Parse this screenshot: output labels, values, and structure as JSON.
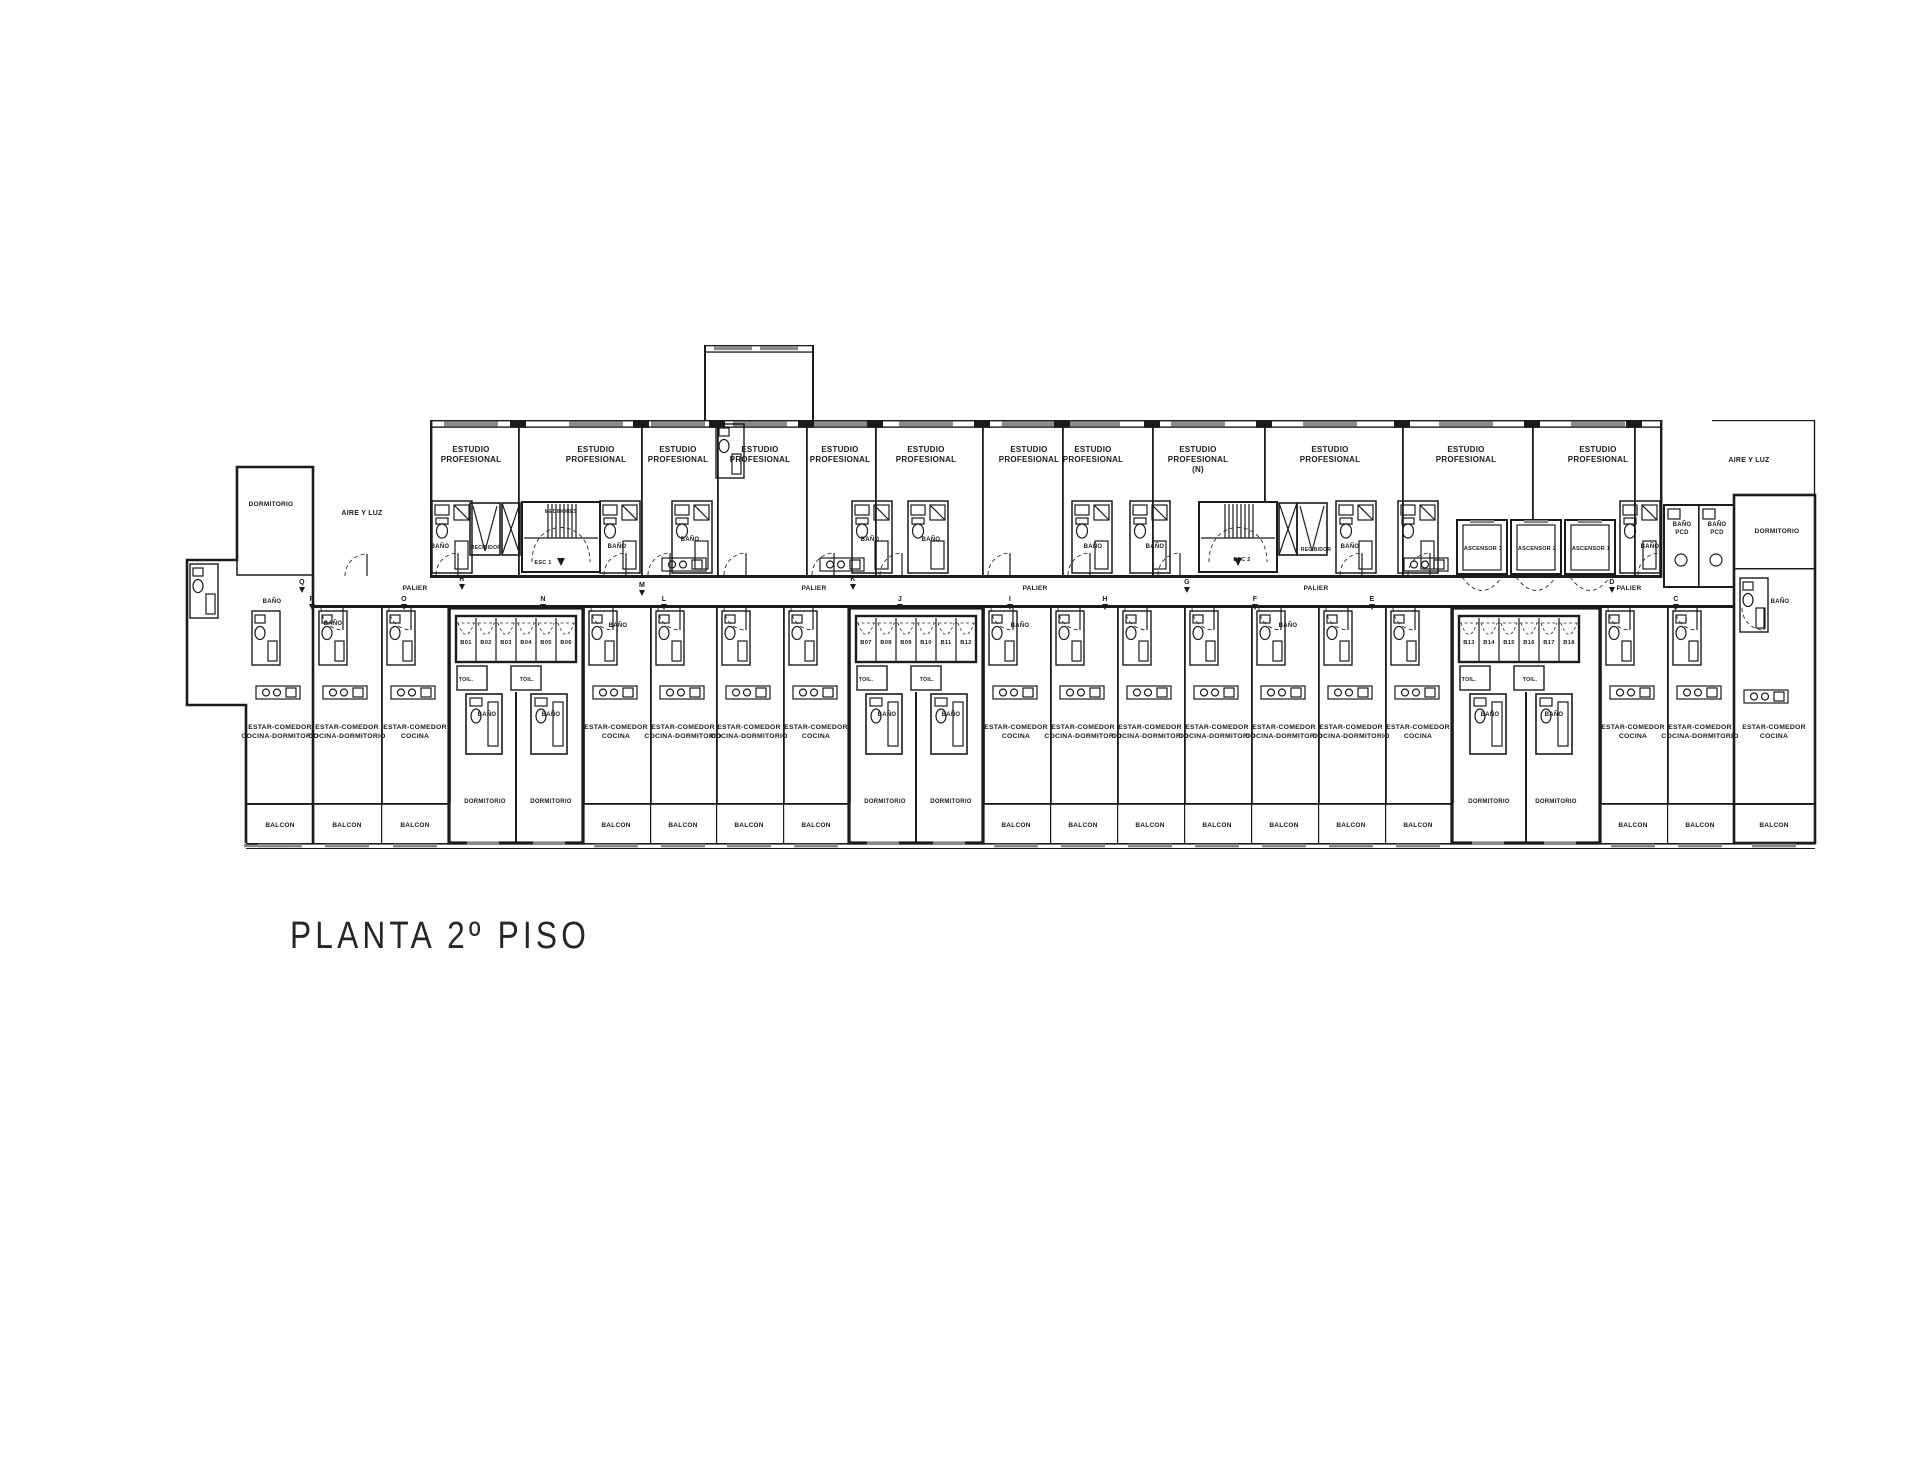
{
  "plan": {
    "title": "PLANTA 2º PISO",
    "labels": [
      {
        "n": "room-label-estudio",
        "t": [
          "ESTUDIO",
          "PROFESIONAL"
        ],
        "x": 471,
        "y": 452,
        "s": 8,
        "dy": 10
      },
      {
        "n": "room-label-estudio",
        "t": [
          "ESTUDIO",
          "PROFESIONAL"
        ],
        "x": 596,
        "y": 452,
        "s": 8,
        "dy": 10
      },
      {
        "n": "room-label-estudio",
        "t": [
          "ESTUDIO",
          "PROFESIONAL"
        ],
        "x": 678,
        "y": 452,
        "s": 8,
        "dy": 10
      },
      {
        "n": "room-label-estudio",
        "t": [
          "ESTUDIO",
          "PROFESIONAL"
        ],
        "x": 760,
        "y": 452,
        "s": 8,
        "dy": 10
      },
      {
        "n": "room-label-estudio",
        "t": [
          "ESTUDIO",
          "PROFESIONAL"
        ],
        "x": 840,
        "y": 452,
        "s": 8,
        "dy": 10
      },
      {
        "n": "room-label-estudio",
        "t": [
          "ESTUDIO",
          "PROFESIONAL"
        ],
        "x": 926,
        "y": 452,
        "s": 8,
        "dy": 10
      },
      {
        "n": "room-label-estudio",
        "t": [
          "ESTUDIO",
          "PROFESIONAL"
        ],
        "x": 1029,
        "y": 452,
        "s": 8,
        "dy": 10
      },
      {
        "n": "room-label-estudio",
        "t": [
          "ESTUDIO",
          "PROFESIONAL"
        ],
        "x": 1093,
        "y": 452,
        "s": 8,
        "dy": 10
      },
      {
        "n": "room-label-estudio",
        "t": [
          "ESTUDIO",
          "PROFESIONAL",
          "(N)"
        ],
        "x": 1198,
        "y": 452,
        "s": 8,
        "dy": 10
      },
      {
        "n": "room-label-estudio",
        "t": [
          "ESTUDIO",
          "PROFESIONAL"
        ],
        "x": 1330,
        "y": 452,
        "s": 8,
        "dy": 10
      },
      {
        "n": "room-label-estudio",
        "t": [
          "ESTUDIO",
          "PROFESIONAL"
        ],
        "x": 1466,
        "y": 452,
        "s": 8,
        "dy": 10
      },
      {
        "n": "room-label-estudio",
        "t": [
          "ESTUDIO",
          "PROFESIONAL"
        ],
        "x": 1598,
        "y": 452,
        "s": 8,
        "dy": 10
      },
      {
        "n": "room-label-aire-y-luz",
        "t": "AIRE Y LUZ",
        "x": 362,
        "y": 515,
        "s": 7
      },
      {
        "n": "room-label-aire-y-luz",
        "t": "AIRE Y LUZ",
        "x": 1749,
        "y": 462,
        "s": 7
      },
      {
        "n": "room-label-dormitorio",
        "t": "DORMITORIO",
        "x": 271,
        "y": 506,
        "s": 6.5
      },
      {
        "n": "room-label-dormitorio",
        "t": "DORMITORIO",
        "x": 1777,
        "y": 533,
        "s": 6.5
      },
      {
        "n": "corridor-label-palier",
        "t": "PALIER",
        "x": 415,
        "y": 590,
        "s": 6.5
      },
      {
        "n": "corridor-label-palier",
        "t": "PALIER",
        "x": 814,
        "y": 590,
        "s": 6.5
      },
      {
        "n": "corridor-label-palier",
        "t": "PALIER",
        "x": 1035,
        "y": 590,
        "s": 6.5
      },
      {
        "n": "corridor-label-palier",
        "t": "PALIER",
        "x": 1316,
        "y": 590,
        "s": 6.5
      },
      {
        "n": "corridor-label-palier",
        "t": "PALIER",
        "x": 1629,
        "y": 590,
        "s": 6.5
      },
      {
        "n": "room-label-recibidor",
        "t": "RECIBIDOR",
        "x": 486,
        "y": 549,
        "s": 5
      },
      {
        "n": "room-label-recibidor",
        "t": "RECIBIDOR",
        "x": 1316,
        "y": 551,
        "s": 5
      },
      {
        "n": "room-label-medidores",
        "t": "MEDIDORES",
        "x": 561,
        "y": 513,
        "s": 5
      },
      {
        "n": "stair-label-esc1",
        "t": "ESC 1",
        "x": 543,
        "y": 564,
        "s": 5.5
      },
      {
        "n": "stair-label-esc2",
        "t": "ESC 2",
        "x": 1242,
        "y": 561,
        "s": 5.5
      },
      {
        "n": "lift-label-ascensor",
        "t": "ASCENSOR 3",
        "x": 1483,
        "y": 550,
        "s": 5.5
      },
      {
        "n": "lift-label-ascensor",
        "t": "ASCENSOR 2",
        "x": 1537,
        "y": 550,
        "s": 5.5
      },
      {
        "n": "lift-label-ascensor",
        "t": "ASCENSOR 1",
        "x": 1591,
        "y": 550,
        "s": 5.5
      },
      {
        "n": "room-label-bano-pcd",
        "t": [
          "BAÑO",
          "PCD"
        ],
        "x": 1682,
        "y": 526,
        "s": 6,
        "dy": 8
      },
      {
        "n": "room-label-bano-pcd",
        "t": [
          "BAÑO",
          "PCD"
        ],
        "x": 1717,
        "y": 526,
        "s": 6,
        "dy": 8
      },
      {
        "n": "room-label-bano",
        "t": "BAÑO",
        "x": 440,
        "y": 548,
        "s": 6
      },
      {
        "n": "room-label-bano",
        "t": "BAÑO",
        "x": 617,
        "y": 548,
        "s": 6
      },
      {
        "n": "room-label-bano",
        "t": "BAÑO",
        "x": 690,
        "y": 541,
        "s": 6
      },
      {
        "n": "room-label-bano",
        "t": "BAÑO",
        "x": 870,
        "y": 541,
        "s": 6
      },
      {
        "n": "room-label-bano",
        "t": "BAÑO",
        "x": 931,
        "y": 541,
        "s": 6
      },
      {
        "n": "room-label-bano",
        "t": "BAÑO",
        "x": 1093,
        "y": 548,
        "s": 6
      },
      {
        "n": "room-label-bano",
        "t": "BAÑO",
        "x": 1155,
        "y": 548,
        "s": 6
      },
      {
        "n": "room-label-bano",
        "t": "BAÑO",
        "x": 1350,
        "y": 548,
        "s": 6
      },
      {
        "n": "room-label-bano",
        "t": "BAÑO",
        "x": 1650,
        "y": 548,
        "s": 6
      },
      {
        "n": "room-label-bano",
        "t": "BAÑO",
        "x": 272,
        "y": 603,
        "s": 6
      },
      {
        "n": "room-label-bano",
        "t": "BAÑO",
        "x": 333,
        "y": 625,
        "s": 6
      },
      {
        "n": "room-label-bano",
        "t": "BAÑO",
        "x": 618,
        "y": 627,
        "s": 6
      },
      {
        "n": "room-label-bano",
        "t": "BAÑO",
        "x": 1020,
        "y": 627,
        "s": 6
      },
      {
        "n": "room-label-bano",
        "t": "BAÑO",
        "x": 1288,
        "y": 627,
        "s": 6
      },
      {
        "n": "room-label-bano",
        "t": "BAÑO",
        "x": 1780,
        "y": 603,
        "s": 6
      },
      {
        "n": "storage-label-baulera",
        "t": "B01",
        "x": 466,
        "y": 644,
        "s": 5.8
      },
      {
        "n": "storage-label-baulera",
        "t": "B02",
        "x": 486,
        "y": 644,
        "s": 5.8
      },
      {
        "n": "storage-label-baulera",
        "t": "B03",
        "x": 506,
        "y": 644,
        "s": 5.8
      },
      {
        "n": "storage-label-baulera",
        "t": "B04",
        "x": 526,
        "y": 644,
        "s": 5.8
      },
      {
        "n": "storage-label-baulera",
        "t": "B05",
        "x": 546,
        "y": 644,
        "s": 5.8
      },
      {
        "n": "storage-label-baulera",
        "t": "B06",
        "x": 566,
        "y": 644,
        "s": 5.8
      },
      {
        "n": "storage-label-baulera",
        "t": "B07",
        "x": 866,
        "y": 644,
        "s": 5.8
      },
      {
        "n": "storage-label-baulera",
        "t": "B08",
        "x": 886,
        "y": 644,
        "s": 5.8
      },
      {
        "n": "storage-label-baulera",
        "t": "B09",
        "x": 906,
        "y": 644,
        "s": 5.8
      },
      {
        "n": "storage-label-baulera",
        "t": "B10",
        "x": 926,
        "y": 644,
        "s": 5.8
      },
      {
        "n": "storage-label-baulera",
        "t": "B11",
        "x": 946,
        "y": 644,
        "s": 5.8
      },
      {
        "n": "storage-label-baulera",
        "t": "B12",
        "x": 966,
        "y": 644,
        "s": 5.8
      },
      {
        "n": "storage-label-baulera",
        "t": "B13",
        "x": 1469,
        "y": 644,
        "s": 5.8
      },
      {
        "n": "storage-label-baulera",
        "t": "B14",
        "x": 1489,
        "y": 644,
        "s": 5.8
      },
      {
        "n": "storage-label-baulera",
        "t": "B15",
        "x": 1509,
        "y": 644,
        "s": 5.8
      },
      {
        "n": "storage-label-baulera",
        "t": "B16",
        "x": 1529,
        "y": 644,
        "s": 5.8
      },
      {
        "n": "storage-label-baulera",
        "t": "B17",
        "x": 1549,
        "y": 644,
        "s": 5.8
      },
      {
        "n": "storage-label-baulera",
        "t": "B18",
        "x": 1569,
        "y": 644,
        "s": 5.8
      },
      {
        "n": "room-label-toilette",
        "t": "TOIL.",
        "x": 466,
        "y": 681,
        "s": 5.2
      },
      {
        "n": "room-label-toilette",
        "t": "TOIL.",
        "x": 527,
        "y": 681,
        "s": 5.2
      },
      {
        "n": "room-label-toilette",
        "t": "TOIL.",
        "x": 866,
        "y": 681,
        "s": 5.2
      },
      {
        "n": "room-label-toilette",
        "t": "TOIL.",
        "x": 927,
        "y": 681,
        "s": 5.2
      },
      {
        "n": "room-label-toilette",
        "t": "TOIL.",
        "x": 1469,
        "y": 681,
        "s": 5.2
      },
      {
        "n": "room-label-toilette",
        "t": "TOIL.",
        "x": 1530,
        "y": 681,
        "s": 5.2
      },
      {
        "n": "room-label-bano",
        "t": "BAÑO",
        "x": 487,
        "y": 716,
        "s": 6
      },
      {
        "n": "room-label-bano",
        "t": "BAÑO",
        "x": 551,
        "y": 716,
        "s": 6
      },
      {
        "n": "room-label-bano",
        "t": "BAÑO",
        "x": 887,
        "y": 716,
        "s": 6
      },
      {
        "n": "room-label-bano",
        "t": "BAÑO",
        "x": 951,
        "y": 716,
        "s": 6
      },
      {
        "n": "room-label-bano",
        "t": "BAÑO",
        "x": 1490,
        "y": 716,
        "s": 6
      },
      {
        "n": "room-label-bano",
        "t": "BAÑO",
        "x": 1554,
        "y": 716,
        "s": 6
      },
      {
        "n": "room-label-dormitorio",
        "t": "DORMITORIO",
        "x": 485,
        "y": 803,
        "s": 6
      },
      {
        "n": "room-label-dormitorio",
        "t": "DORMITORIO",
        "x": 551,
        "y": 803,
        "s": 6
      },
      {
        "n": "room-label-dormitorio",
        "t": "DORMITORIO",
        "x": 885,
        "y": 803,
        "s": 6
      },
      {
        "n": "room-label-dormitorio",
        "t": "DORMITORIO",
        "x": 951,
        "y": 803,
        "s": 6
      },
      {
        "n": "room-label-dormitorio",
        "t": "DORMITORIO",
        "x": 1489,
        "y": 803,
        "s": 6
      },
      {
        "n": "room-label-dormitorio",
        "t": "DORMITORIO",
        "x": 1556,
        "y": 803,
        "s": 6
      },
      {
        "n": "room-label-estar",
        "t": [
          "ESTAR-COMEDOR",
          "COCINA-DORMITORIO"
        ],
        "x": 280,
        "y": 729,
        "s": 6.8,
        "dy": 9
      },
      {
        "n": "room-label-estar",
        "t": [
          "ESTAR-COMEDOR",
          "COCINA-DORMITORIO"
        ],
        "x": 347,
        "y": 729,
        "s": 6.8,
        "dy": 9
      },
      {
        "n": "room-label-estar",
        "t": [
          "ESTAR-COMEDOR",
          "COCINA"
        ],
        "x": 415,
        "y": 729,
        "s": 6.8,
        "dy": 9
      },
      {
        "n": "room-label-estar",
        "t": [
          "ESTAR-COMEDOR",
          "COCINA"
        ],
        "x": 616,
        "y": 729,
        "s": 6.8,
        "dy": 9
      },
      {
        "n": "room-label-estar",
        "t": [
          "ESTAR-COMEDOR",
          "COCINA-DORMITORIO"
        ],
        "x": 683,
        "y": 729,
        "s": 6.8,
        "dy": 9
      },
      {
        "n": "room-label-estar",
        "t": [
          "ESTAR-COMEDOR",
          "COCINA-DORMITORIO"
        ],
        "x": 749,
        "y": 729,
        "s": 6.8,
        "dy": 9
      },
      {
        "n": "room-label-estar",
        "t": [
          "ESTAR-COMEDOR",
          "COCINA"
        ],
        "x": 816,
        "y": 729,
        "s": 6.8,
        "dy": 9
      },
      {
        "n": "room-label-estar",
        "t": [
          "ESTAR-COMEDOR",
          "COCINA"
        ],
        "x": 1016,
        "y": 729,
        "s": 6.8,
        "dy": 9
      },
      {
        "n": "room-label-estar",
        "t": [
          "ESTAR-COMEDOR",
          "COCINA-DORMITORIO"
        ],
        "x": 1083,
        "y": 729,
        "s": 6.8,
        "dy": 9
      },
      {
        "n": "room-label-estar",
        "t": [
          "ESTAR-COMEDOR",
          "COCINA-DORMITORIO"
        ],
        "x": 1150,
        "y": 729,
        "s": 6.8,
        "dy": 9
      },
      {
        "n": "room-label-estar",
        "t": [
          "ESTAR-COMEDOR",
          "COCINA-DORMITORIO"
        ],
        "x": 1217,
        "y": 729,
        "s": 6.8,
        "dy": 9
      },
      {
        "n": "room-label-estar",
        "t": [
          "ESTAR-COMEDOR",
          "COCINA-DORMITORIO"
        ],
        "x": 1284,
        "y": 729,
        "s": 6.8,
        "dy": 9
      },
      {
        "n": "room-label-estar",
        "t": [
          "ESTAR-COMEDOR",
          "COCINA-DORMITORIO"
        ],
        "x": 1351,
        "y": 729,
        "s": 6.8,
        "dy": 9
      },
      {
        "n": "room-label-estar",
        "t": [
          "ESTAR-COMEDOR",
          "COCINA"
        ],
        "x": 1418,
        "y": 729,
        "s": 6.8,
        "dy": 9
      },
      {
        "n": "room-label-estar",
        "t": [
          "ESTAR-COMEDOR",
          "COCINA"
        ],
        "x": 1633,
        "y": 729,
        "s": 6.8,
        "dy": 9
      },
      {
        "n": "room-label-estar",
        "t": [
          "ESTAR-COMEDOR",
          "COCINA-DORMITORIO"
        ],
        "x": 1700,
        "y": 729,
        "s": 6.8,
        "dy": 9
      },
      {
        "n": "room-label-estar",
        "t": [
          "ESTAR-COMEDOR",
          "COCINA"
        ],
        "x": 1774,
        "y": 729,
        "s": 6.8,
        "dy": 9
      },
      {
        "n": "room-label-balcon",
        "t": "BALCON",
        "x": 280,
        "y": 827,
        "s": 6.5
      },
      {
        "n": "room-label-balcon",
        "t": "BALCON",
        "x": 347,
        "y": 827,
        "s": 6.5
      },
      {
        "n": "room-label-balcon",
        "t": "BALCON",
        "x": 415,
        "y": 827,
        "s": 6.5
      },
      {
        "n": "room-label-balcon",
        "t": "BALCON",
        "x": 616,
        "y": 827,
        "s": 6.5
      },
      {
        "n": "room-label-balcon",
        "t": "BALCON",
        "x": 683,
        "y": 827,
        "s": 6.5
      },
      {
        "n": "room-label-balcon",
        "t": "BALCON",
        "x": 749,
        "y": 827,
        "s": 6.5
      },
      {
        "n": "room-label-balcon",
        "t": "BALCON",
        "x": 816,
        "y": 827,
        "s": 6.5
      },
      {
        "n": "room-label-balcon",
        "t": "BALCON",
        "x": 1016,
        "y": 827,
        "s": 6.5
      },
      {
        "n": "room-label-balcon",
        "t": "BALCON",
        "x": 1083,
        "y": 827,
        "s": 6.5
      },
      {
        "n": "room-label-balcon",
        "t": "BALCON",
        "x": 1150,
        "y": 827,
        "s": 6.5
      },
      {
        "n": "room-label-balcon",
        "t": "BALCON",
        "x": 1217,
        "y": 827,
        "s": 6.5
      },
      {
        "n": "room-label-balcon",
        "t": "BALCON",
        "x": 1284,
        "y": 827,
        "s": 6.5
      },
      {
        "n": "room-label-balcon",
        "t": "BALCON",
        "x": 1351,
        "y": 827,
        "s": 6.5
      },
      {
        "n": "room-label-balcon",
        "t": "BALCON",
        "x": 1418,
        "y": 827,
        "s": 6.5
      },
      {
        "n": "room-label-balcon",
        "t": "BALCON",
        "x": 1633,
        "y": 827,
        "s": 6.5
      },
      {
        "n": "room-label-balcon",
        "t": "BALCON",
        "x": 1700,
        "y": 827,
        "s": 6.5
      },
      {
        "n": "room-label-balcon",
        "t": "BALCON",
        "x": 1774,
        "y": 827,
        "s": 6.5
      },
      {
        "n": "grid-marker",
        "t": "R",
        "x": 462,
        "y": 581,
        "s": 7,
        "m": true
      },
      {
        "n": "grid-marker",
        "t": "Q",
        "x": 302,
        "y": 584,
        "s": 7,
        "m": true
      },
      {
        "n": "grid-marker",
        "t": "P",
        "x": 312,
        "y": 601,
        "s": 7,
        "m": true
      },
      {
        "n": "grid-marker",
        "t": "O",
        "x": 404,
        "y": 601,
        "s": 7,
        "m": true
      },
      {
        "n": "grid-marker",
        "t": "N",
        "x": 543,
        "y": 601,
        "s": 7,
        "m": true
      },
      {
        "n": "grid-marker",
        "t": "M",
        "x": 642,
        "y": 587,
        "s": 7,
        "m": true
      },
      {
        "n": "grid-marker",
        "t": "L",
        "x": 664,
        "y": 601,
        "s": 7,
        "m": true
      },
      {
        "n": "grid-marker",
        "t": "K",
        "x": 853,
        "y": 581,
        "s": 7,
        "m": true
      },
      {
        "n": "grid-marker",
        "t": "J",
        "x": 900,
        "y": 601,
        "s": 7,
        "m": true
      },
      {
        "n": "grid-marker",
        "t": "I",
        "x": 1010,
        "y": 601,
        "s": 7,
        "m": true
      },
      {
        "n": "grid-marker",
        "t": "H",
        "x": 1105,
        "y": 601,
        "s": 7,
        "m": true
      },
      {
        "n": "grid-marker",
        "t": "G",
        "x": 1187,
        "y": 584,
        "s": 7,
        "m": true
      },
      {
        "n": "grid-marker",
        "t": "F",
        "x": 1255,
        "y": 601,
        "s": 7,
        "m": true
      },
      {
        "n": "grid-marker",
        "t": "E",
        "x": 1372,
        "y": 601,
        "s": 7,
        "m": true
      },
      {
        "n": "grid-marker",
        "t": "D",
        "x": 1612,
        "y": 584,
        "s": 7,
        "m": true
      },
      {
        "n": "grid-marker",
        "t": "C",
        "x": 1676,
        "y": 601,
        "s": 7,
        "m": true
      }
    ]
  }
}
